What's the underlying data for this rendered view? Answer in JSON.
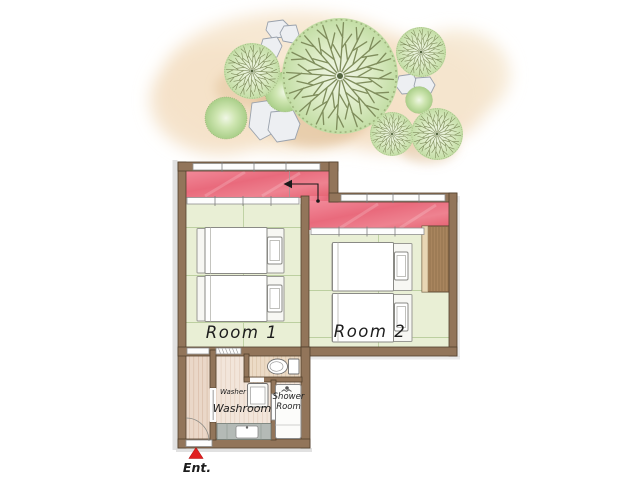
{
  "title": "Guest room floor plan illustration",
  "floorplan": {
    "room1": {
      "label": "Room 1",
      "beds": 2
    },
    "room2": {
      "label": "Room 2",
      "beds": 2,
      "has_closet": true
    },
    "washroom": {
      "label": "Washroom",
      "fixtures": [
        "washer",
        "vanity-sink"
      ]
    },
    "washer": {
      "label": "Washer"
    },
    "shower_room": {
      "label": "Shower Room"
    },
    "toilet": {
      "fixture": "toilet"
    },
    "entrance": {
      "label": "Ent.",
      "marker": "red-triangle-up"
    }
  },
  "garden": {
    "radial_trees": 5,
    "round_trees": 3,
    "stepping_stones": 7
  },
  "colors": {
    "veranda_red": "#e96a7c",
    "tatami_green": "#e9efd5",
    "wall_brown": "#92755a",
    "wood_floor": "#ead7c8",
    "closet_wood": "#a9855e",
    "tree_green": "#c6dfa9",
    "garden_wash_peach": "#f6e7d0",
    "entrance_marker_red": "#e01f1f"
  }
}
